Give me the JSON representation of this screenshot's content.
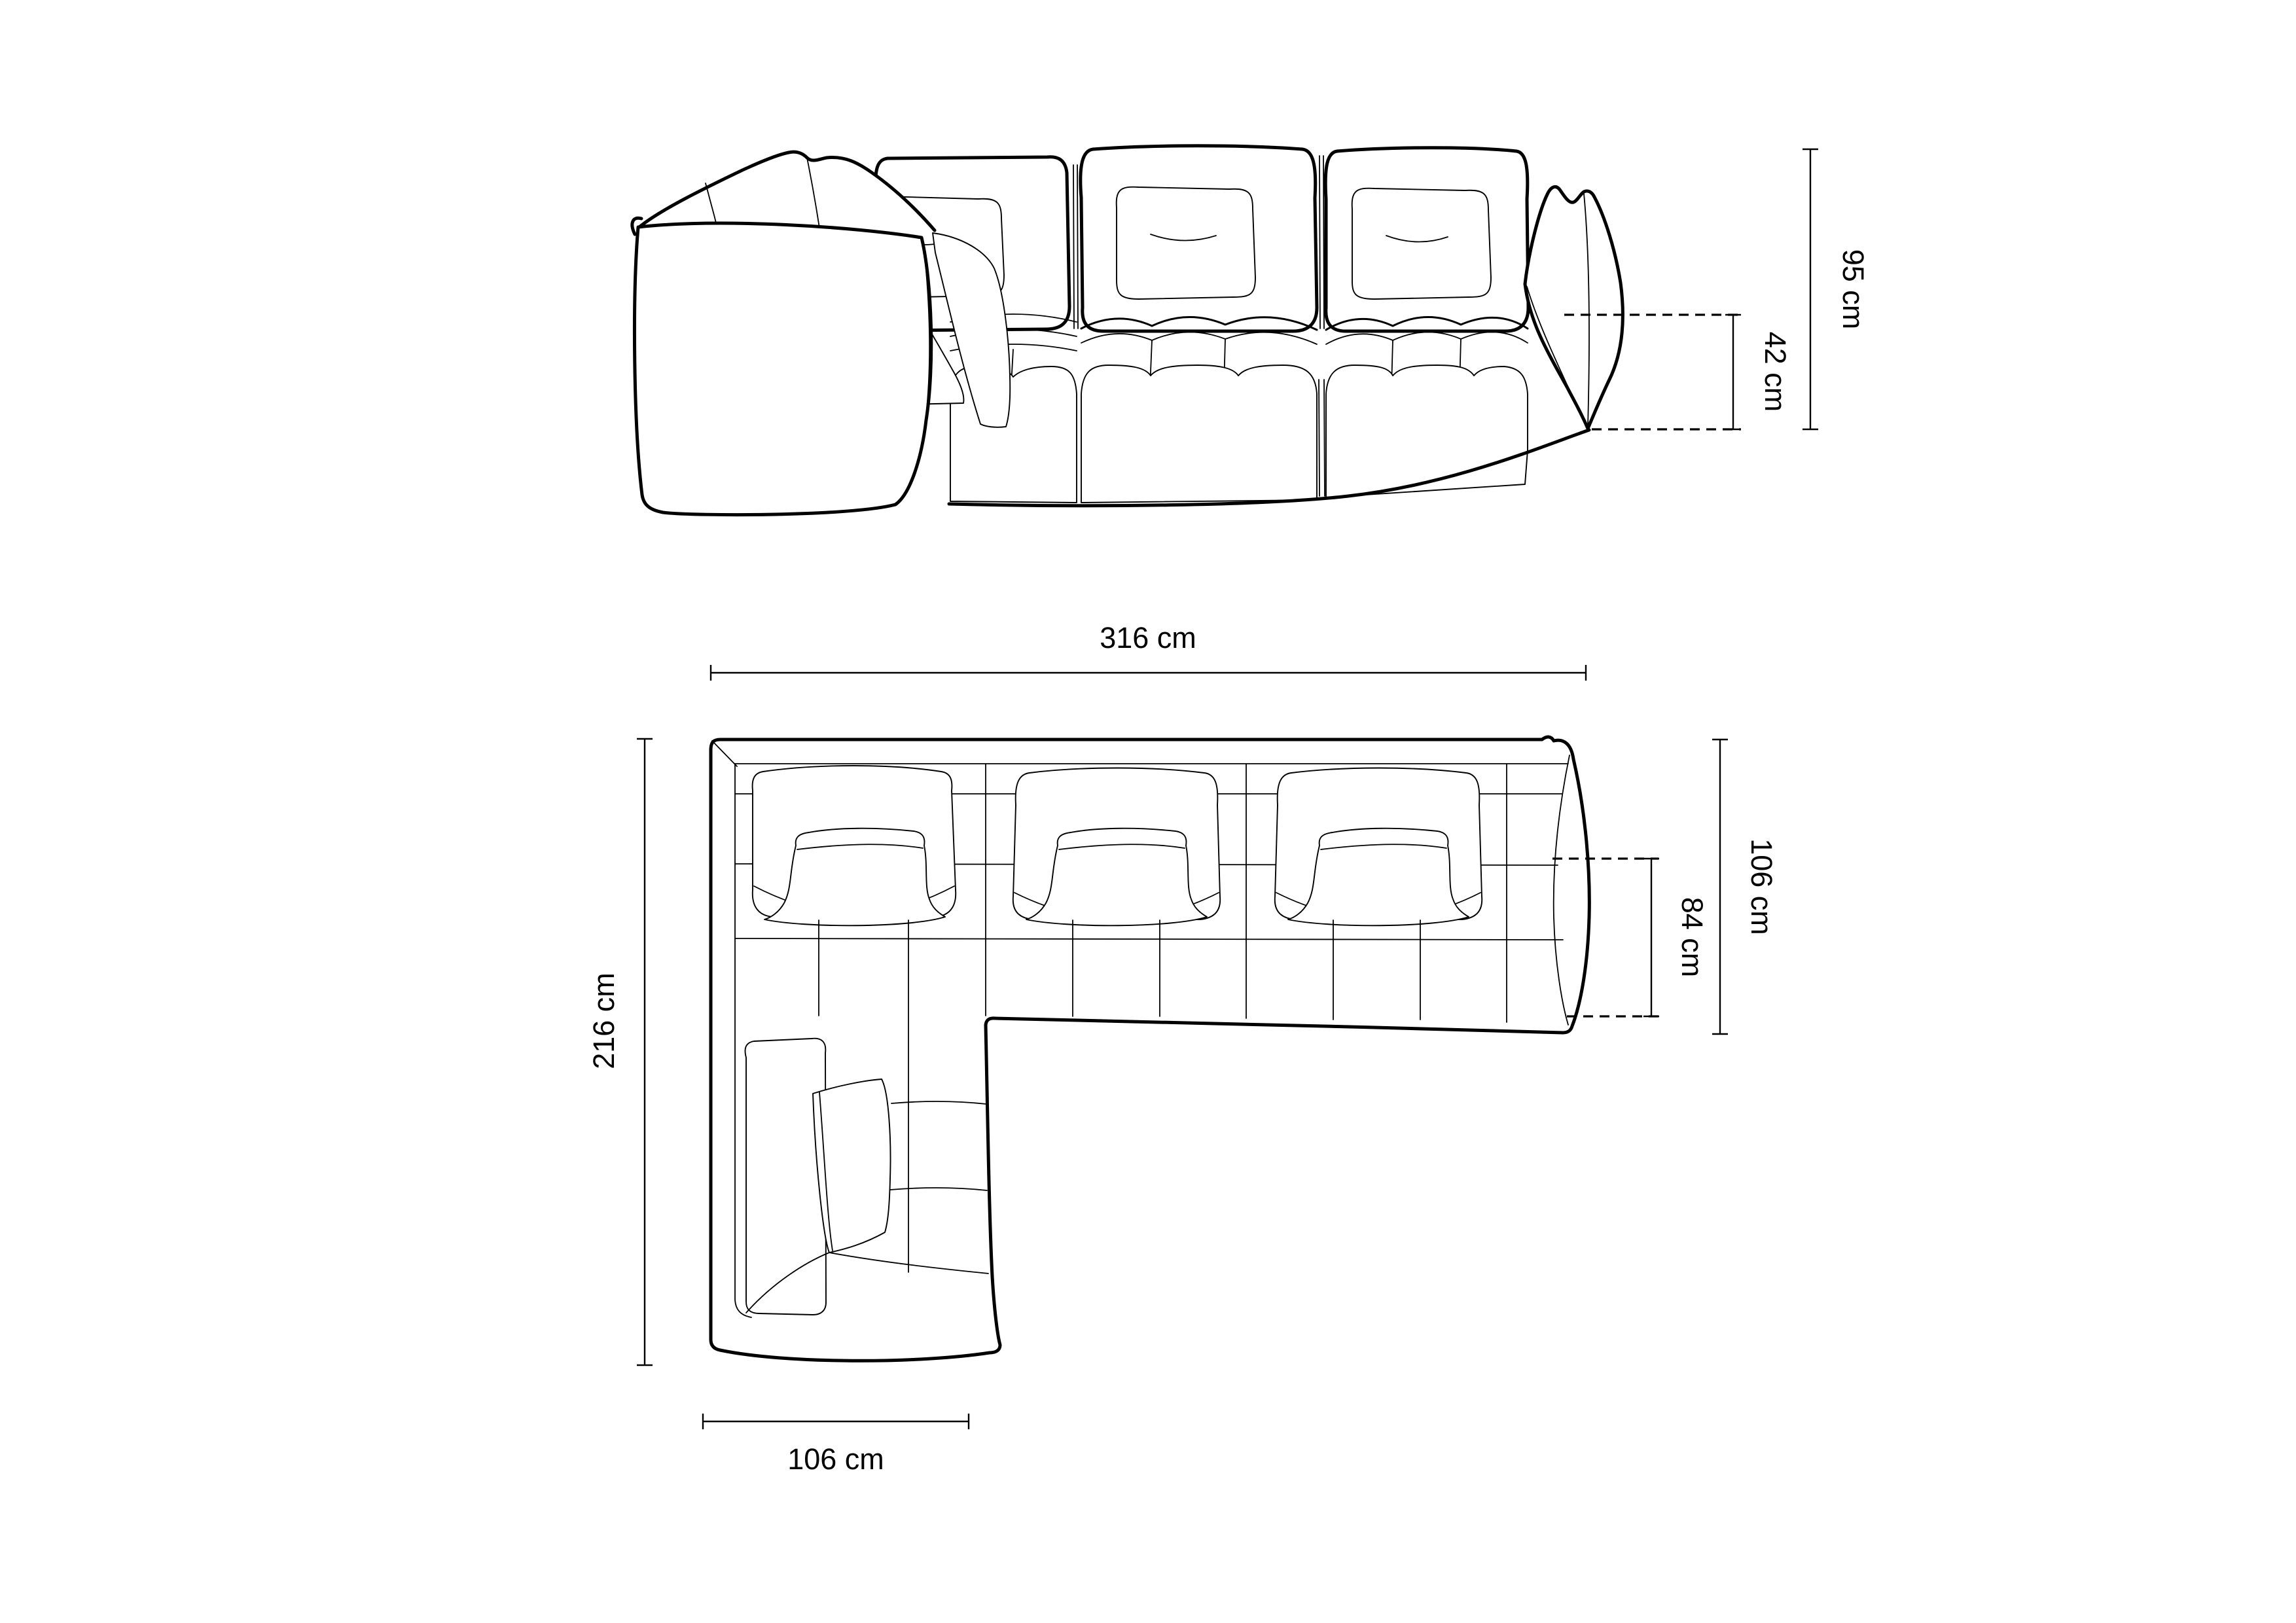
{
  "drawing": {
    "title": "corner-sofa-technical-dimension-drawing",
    "background_color": "#ffffff",
    "line_color": "#000000",
    "front_view": {
      "name": "front elevation",
      "dimensions": {
        "total_height": "95 cm",
        "seat_height": "42 cm"
      }
    },
    "top_view": {
      "name": "top plan",
      "dimensions": {
        "total_width": "316 cm",
        "total_depth": "216 cm",
        "right_module_depth": "106 cm",
        "inner_seat_depth": "84 cm",
        "chaise_width": "106 cm"
      }
    }
  }
}
